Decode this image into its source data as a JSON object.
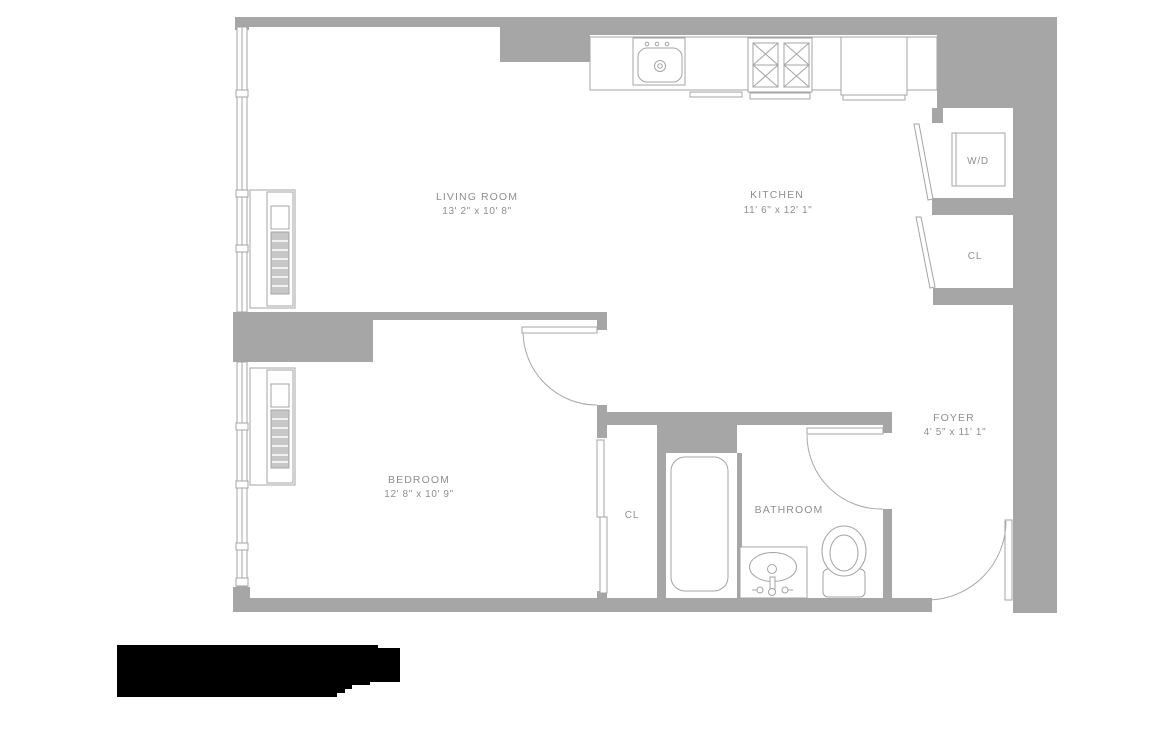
{
  "rooms": {
    "living_room": {
      "name": "LIVING ROOM",
      "dims": "13' 2\" x 10' 8\""
    },
    "kitchen": {
      "name": "KITCHEN",
      "dims": "11' 6\" x 12' 1\""
    },
    "bedroom": {
      "name": "BEDROOM",
      "dims": "12' 8\" x 10' 9\""
    },
    "bathroom": {
      "name": "BATHROOM"
    },
    "foyer": {
      "name": "FOYER",
      "dims": "4' 5\" x 11' 1\""
    },
    "washer_dryer": {
      "name": "W/D"
    },
    "closet_foyer": {
      "name": "CL"
    },
    "closet_bedroom": {
      "name": "CL"
    }
  },
  "colors": {
    "wall": "#a6a6a6",
    "fixture_line": "#a4a4a4",
    "label_text": "#8f8f8f",
    "logo": "#000000",
    "background": "#ffffff"
  }
}
